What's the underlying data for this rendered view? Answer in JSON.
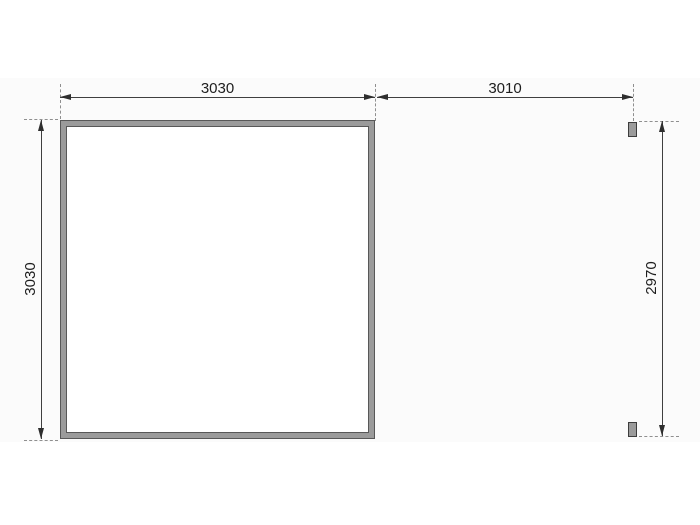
{
  "drawing": {
    "description": "floor-plan dimension drawing of a square structure with side posts",
    "dimension_labels": {
      "main_width": "3030",
      "annex_width": "3010",
      "main_depth": "3030",
      "annex_depth": "2970"
    },
    "colors": {
      "dimension_line": "#3f3f3f",
      "extension_dash": "#8f8f8f",
      "wall_fill": "#9b9b9b",
      "wall_outline": "#565656",
      "post_fill": "#9b9b9b",
      "post_outline": "#3d3d3d",
      "label_text": "#1e1e1e",
      "background": "#ffffff"
    }
  }
}
